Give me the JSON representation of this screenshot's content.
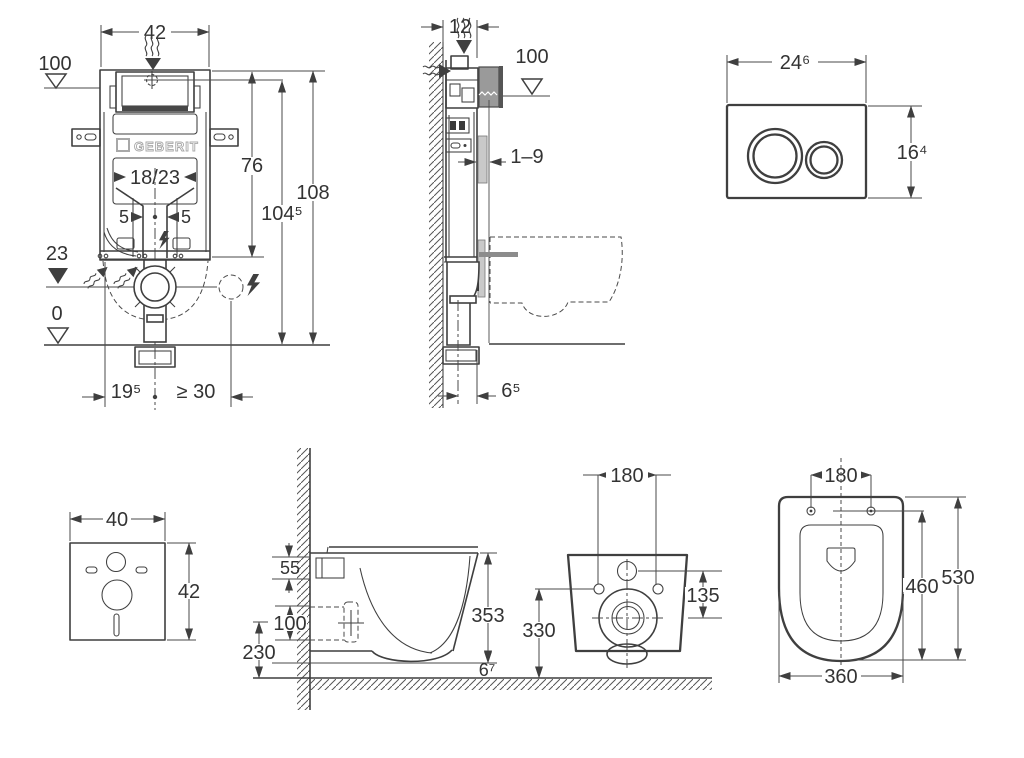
{
  "frame_front": {
    "w42": "42",
    "lvl100": "100",
    "h76": "76",
    "h108": "108",
    "h104_5": "104⁵",
    "w18_23": "18/23",
    "off5_left": "5",
    "off5_right": "5",
    "lvl23": "23",
    "lvl0": "0",
    "d19_5": "19⁵",
    "d_ge30": "≥ 30",
    "brand": "GEBERIT"
  },
  "frame_side": {
    "d12": "12",
    "lvl100": "100",
    "tile": "1–9",
    "d6_5": "6⁵"
  },
  "plate": {
    "w": "24⁶",
    "h": "16⁴"
  },
  "mat": {
    "w": "40",
    "h": "42"
  },
  "wc_side": {
    "d55": "55",
    "d100": "100",
    "d230": "230",
    "h353": "353",
    "d6_7": "6⁷"
  },
  "wc_rear": {
    "holes": "180",
    "d135": "135",
    "h330": "330"
  },
  "wc_top": {
    "holes": "180",
    "inner": "460",
    "length": "530",
    "width": "360"
  },
  "colors": {
    "line": "#3f3f3f",
    "gray": "#9a9a9a",
    "light_gray": "#c9c9c9",
    "logo_gray": "#a8a8a8",
    "background": "#ffffff"
  }
}
